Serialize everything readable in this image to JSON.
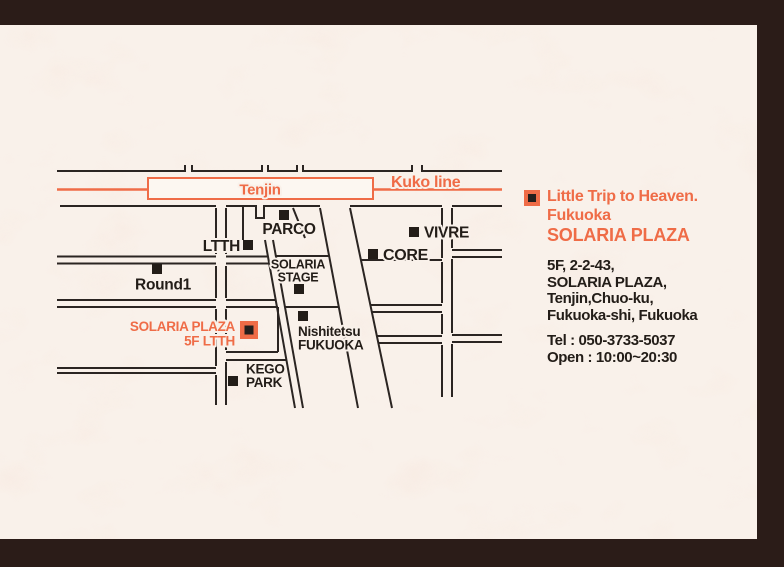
{
  "page": {
    "background_color": "#2b1c18",
    "paper_color": "#f9f1ea",
    "accent_color": "#ef6c47",
    "ink_color": "#231d18"
  },
  "map": {
    "station": {
      "label": "Tenjin"
    },
    "rail_line": {
      "label": "Kuko line"
    },
    "landmarks": [
      {
        "id": "parco",
        "label": "PARCO"
      },
      {
        "id": "ltth",
        "label": "LTTH"
      },
      {
        "id": "round1",
        "label": "Round1"
      },
      {
        "id": "vivre",
        "label": "VIVRE"
      },
      {
        "id": "core",
        "label": "CORE"
      },
      {
        "id": "solaria-stage",
        "label": "SOLARIA",
        "label2": "STAGE"
      },
      {
        "id": "nishitetsu-fukuoka",
        "label": "Nishitetsu",
        "label2": "FUKUOKA"
      },
      {
        "id": "kego-park",
        "label": "KEGO",
        "label2": "PARK"
      }
    ],
    "destination": {
      "label_line1": "SOLARIA PLAZA",
      "label_line2": "5F LTTH"
    }
  },
  "info": {
    "title_line1": "Little Trip to Heaven.",
    "title_line2": "Fukuoka",
    "title_line3": "SOLARIA PLAZA",
    "address_line1": "5F, 2-2-43,",
    "address_line2": "SOLARIA PLAZA,",
    "address_line3": "Tenjin,Chuo-ku,",
    "address_line4": "Fukuoka-shi, Fukuoka",
    "tel": "Tel : 050-3733-5037",
    "open": "Open : 10:00~20:30"
  }
}
